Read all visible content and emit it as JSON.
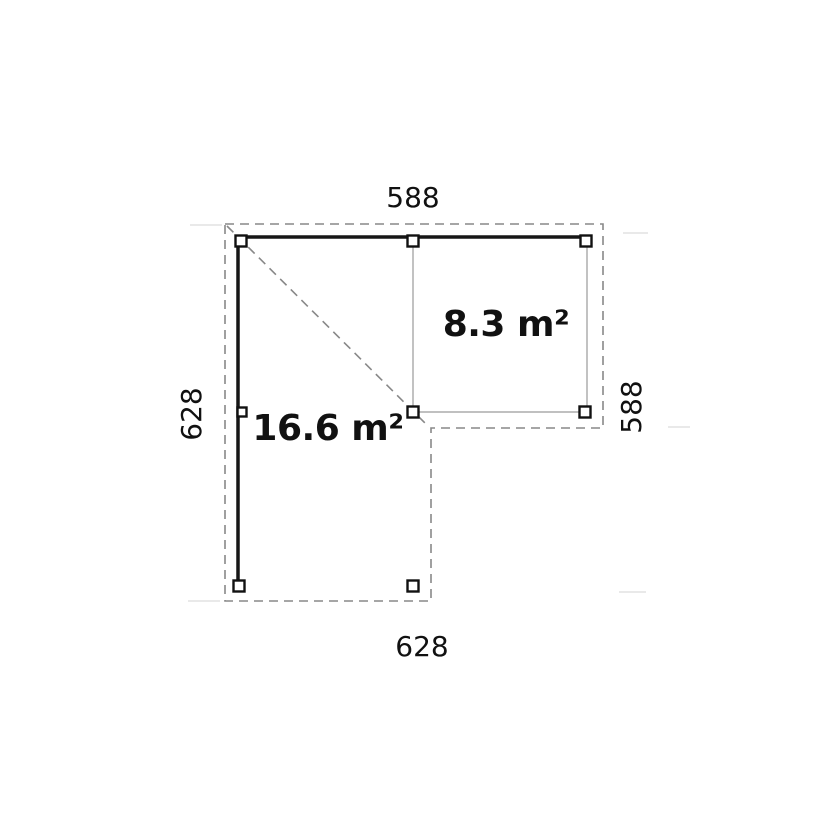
{
  "plan": {
    "title": "L-shaped carport floor plan",
    "dimension_labels": {
      "top": "588",
      "bottom": "628",
      "left": "628",
      "right": "588"
    },
    "area_labels": {
      "main": "16.6 m²",
      "secondary": "8.3 m²"
    },
    "colors": {
      "background": "#ffffff",
      "beam": "#161616",
      "post_border": "#111111",
      "post_fill": "#ffffff",
      "thin_wall": "#9a9a9a",
      "dashed_outline": "#888888",
      "extension_mark": "#dcdcdc",
      "label_text": "#111111"
    }
  }
}
